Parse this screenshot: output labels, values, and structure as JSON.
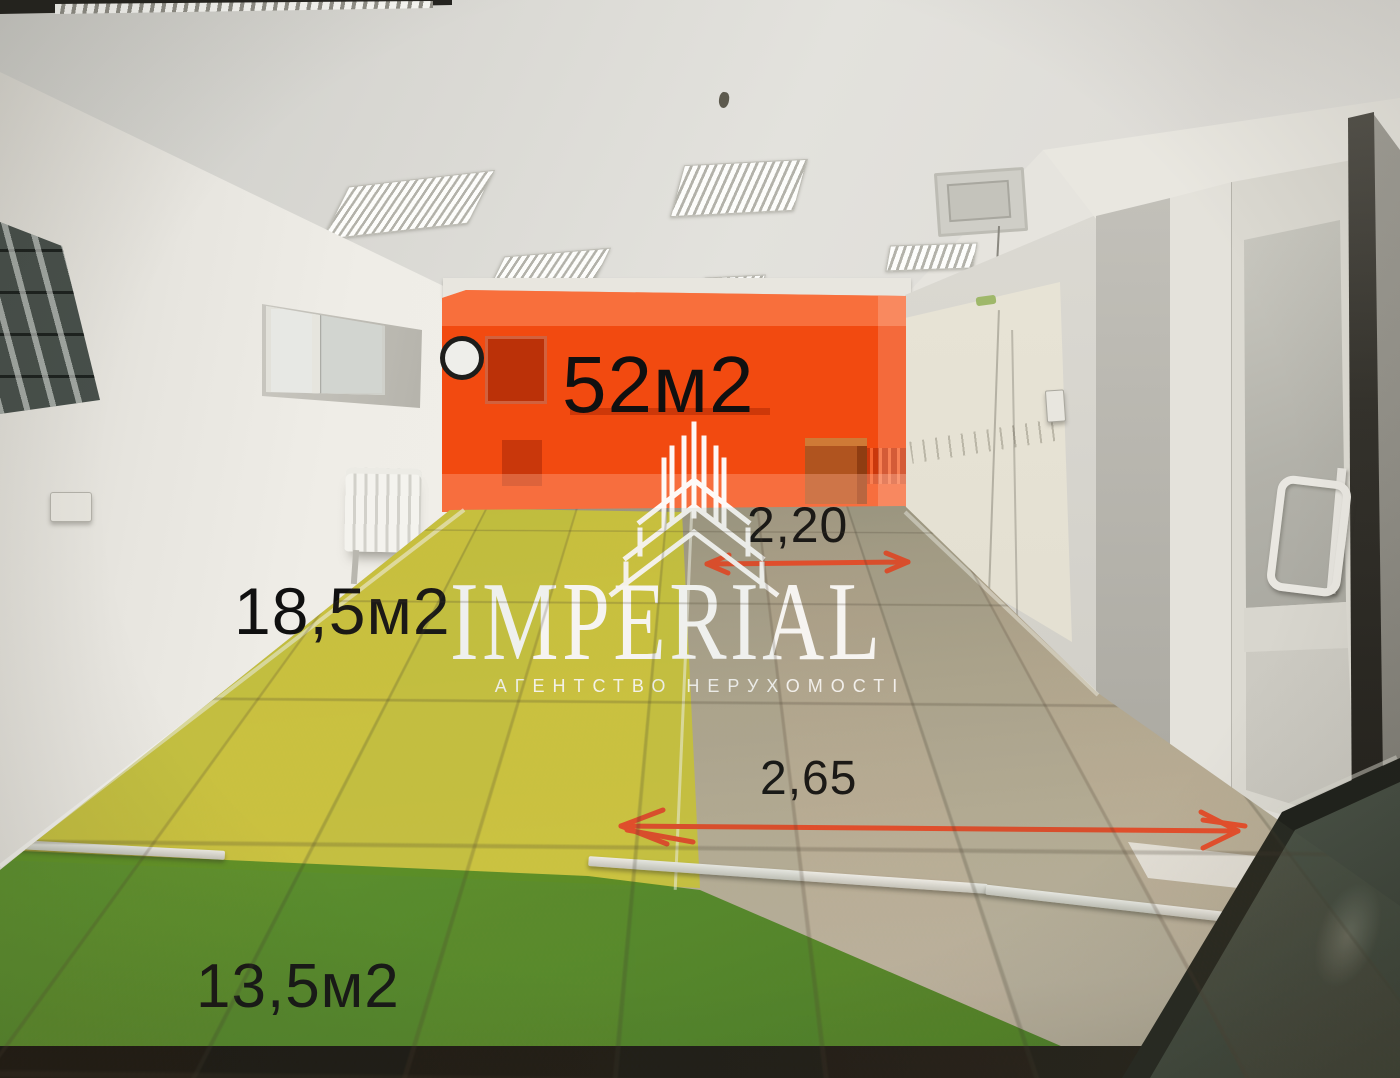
{
  "photo": {
    "type": "real-estate-interior-photo",
    "zones": {
      "back_area_label": "52м2",
      "middle_area_label": "18,5м2",
      "front_area_label": "13,5м2"
    },
    "measurements": {
      "back_width": "2,20",
      "front_width": "2,65"
    },
    "colors": {
      "back_zone_highlight": "#f24a10",
      "middle_zone_highlight": "#d2cc32",
      "front_zone_highlight": "#55941f",
      "measure_arrow": "#e64a28",
      "label_text": "#101010"
    }
  },
  "watermark": {
    "brand": "IMPERIAL",
    "tagline": "АГЕНТСТВО НЕРУХОМОСТІ",
    "color": "#ffffff"
  }
}
